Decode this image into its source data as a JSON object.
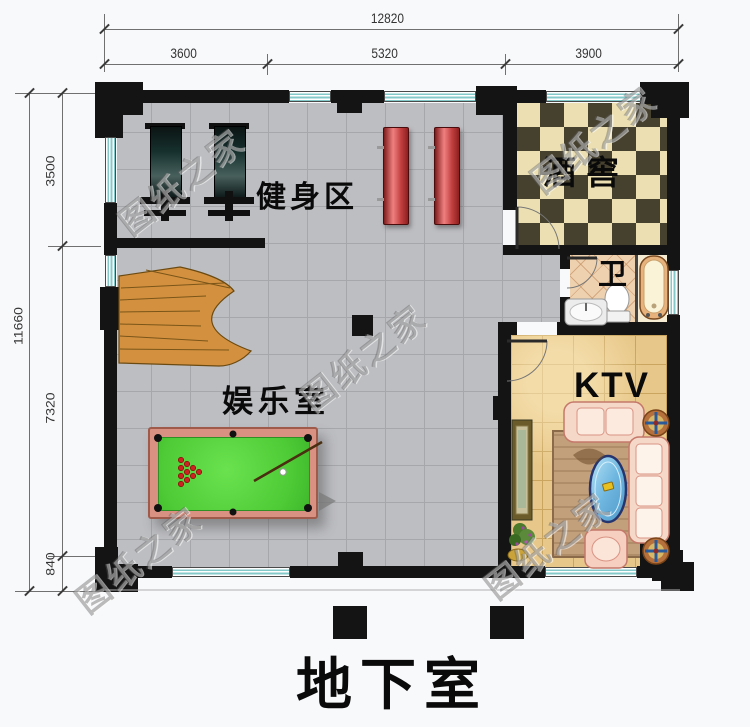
{
  "plan": {
    "title": "地下室",
    "watermark": "图纸之家",
    "rooms": {
      "gym": "健身区",
      "cellar": "酒窖",
      "bath": "卫",
      "entertainment": "娱乐室",
      "ktv": "KTV"
    },
    "dims": {
      "top_total": "12820",
      "top_segments": [
        "3600",
        "5320",
        "3900"
      ],
      "left_total": "11660",
      "left_segments": [
        "3500",
        "7320",
        "840"
      ]
    },
    "colors": {
      "wall": "#141414",
      "floor_gray": "#bdbec2",
      "cellar_dark": "#46412f",
      "cellar_light": "#ece0b2",
      "bath_floor": "#eed2b0",
      "ktv_floor": "#e8c88a",
      "window_teal": "#84c9c9",
      "pool_felt": "#4ecb36",
      "pool_rail": "#d99182",
      "equipment_red": "#c24040",
      "stairs_wood": "#d3913f"
    }
  }
}
